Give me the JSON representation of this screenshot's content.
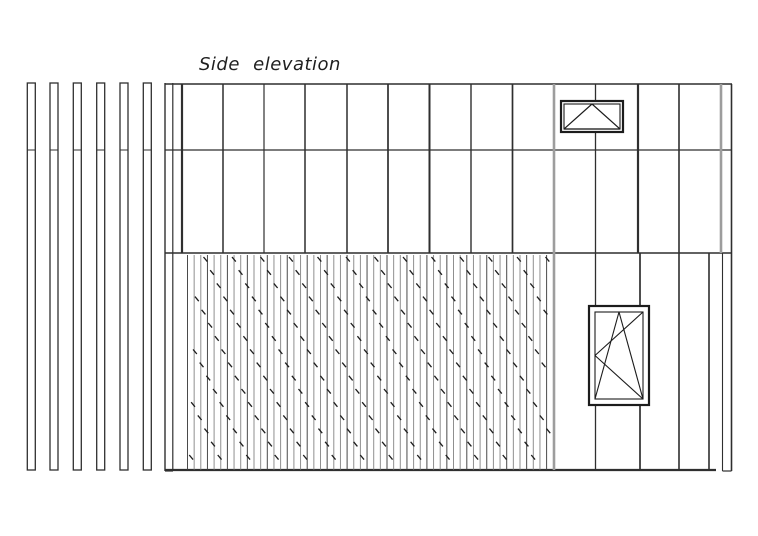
{
  "title": {
    "text": "Side elevation"
  },
  "colors": {
    "background": "#ffffff",
    "line_dark": "#2f2f2f",
    "line_medium": "#4a4a4a",
    "line_light": "#9d9d9d",
    "plank_light": "#8f8f8f",
    "hatch_mark": "#1d1d1d",
    "window_frame": "#1c1c1c"
  },
  "drawing": {
    "canvas": {
      "width": 758,
      "height": 536
    },
    "left_fins": {
      "count": 6,
      "x_positions": [
        27.3,
        50,
        73.3,
        96.7,
        120,
        143.3
      ],
      "width": 8,
      "top": 83,
      "bottom": 470,
      "divider_y": 150
    },
    "facade": {
      "lines": [
        {
          "x1": 165,
          "y1": 84,
          "x2": 732,
          "y2": 84,
          "w": 1.5,
          "tone": "dark"
        },
        {
          "x1": 165,
          "y1": 150,
          "x2": 732,
          "y2": 150,
          "w": 1.2,
          "tone": "dark"
        },
        {
          "x1": 165,
          "y1": 253,
          "x2": 732,
          "y2": 253,
          "w": 1.5,
          "tone": "dark"
        },
        {
          "x1": 165,
          "y1": 470,
          "x2": 716,
          "y2": 470,
          "w": 2.2,
          "tone": "dark"
        },
        {
          "x1": 165,
          "y1": 471,
          "x2": 173,
          "y2": 471,
          "w": 1.2,
          "tone": "dark"
        },
        {
          "x1": 722.5,
          "y1": 471,
          "x2": 731.5,
          "y2": 471,
          "w": 1.2,
          "tone": "dark"
        },
        {
          "x1": 165,
          "y1": 83,
          "x2": 165,
          "y2": 471,
          "w": 1.4,
          "tone": "dark"
        },
        {
          "x1": 172.8,
          "y1": 83,
          "x2": 172.8,
          "y2": 471,
          "w": 1.2,
          "tone": "dark"
        },
        {
          "x1": 182,
          "y1": 84,
          "x2": 182,
          "y2": 253,
          "w": 2.2,
          "tone": "dark"
        },
        {
          "x1": 223,
          "y1": 84,
          "x2": 223,
          "y2": 253,
          "w": 1.5,
          "tone": "dark"
        },
        {
          "x1": 264,
          "y1": 84,
          "x2": 264,
          "y2": 253,
          "w": 1.2,
          "tone": "dark"
        },
        {
          "x1": 305,
          "y1": 84,
          "x2": 305,
          "y2": 253,
          "w": 1.5,
          "tone": "dark"
        },
        {
          "x1": 347,
          "y1": 84,
          "x2": 347,
          "y2": 253,
          "w": 1.5,
          "tone": "dark"
        },
        {
          "x1": 388,
          "y1": 84,
          "x2": 388,
          "y2": 253,
          "w": 1.7,
          "tone": "dark"
        },
        {
          "x1": 429.5,
          "y1": 84,
          "x2": 429.5,
          "y2": 253,
          "w": 2.0,
          "tone": "dark"
        },
        {
          "x1": 471,
          "y1": 84,
          "x2": 471,
          "y2": 253,
          "w": 1.4,
          "tone": "dark"
        },
        {
          "x1": 512.5,
          "y1": 84,
          "x2": 512.5,
          "y2": 253,
          "w": 1.7,
          "tone": "dark"
        },
        {
          "x1": 554,
          "y1": 84,
          "x2": 554,
          "y2": 470,
          "w": 2.6,
          "tone": "light"
        },
        {
          "x1": 595.5,
          "y1": 84,
          "x2": 595.5,
          "y2": 101,
          "w": 1.3,
          "tone": "dark"
        },
        {
          "x1": 595.5,
          "y1": 132,
          "x2": 595.5,
          "y2": 306,
          "w": 1.3,
          "tone": "dark"
        },
        {
          "x1": 595.5,
          "y1": 405,
          "x2": 595.5,
          "y2": 470,
          "w": 1.3,
          "tone": "dark"
        },
        {
          "x1": 638,
          "y1": 84,
          "x2": 638,
          "y2": 253,
          "w": 2.2,
          "tone": "dark"
        },
        {
          "x1": 640,
          "y1": 253,
          "x2": 640,
          "y2": 306,
          "w": 1.7,
          "tone": "dark"
        },
        {
          "x1": 640,
          "y1": 405,
          "x2": 640,
          "y2": 470,
          "w": 1.7,
          "tone": "dark"
        },
        {
          "x1": 679,
          "y1": 84,
          "x2": 679,
          "y2": 470,
          "w": 1.6,
          "tone": "dark"
        },
        {
          "x1": 709,
          "y1": 253,
          "x2": 709,
          "y2": 470,
          "w": 1.6,
          "tone": "dark"
        },
        {
          "x1": 721,
          "y1": 84,
          "x2": 721,
          "y2": 253,
          "w": 2.6,
          "tone": "light"
        },
        {
          "x1": 722.5,
          "y1": 253,
          "x2": 722.5,
          "y2": 471,
          "w": 1.1,
          "tone": "dark"
        },
        {
          "x1": 731.5,
          "y1": 84,
          "x2": 731.5,
          "y2": 471,
          "w": 1.6,
          "tone": "dark"
        }
      ]
    },
    "hatch": {
      "left": 187.5,
      "right": 553,
      "top": 255,
      "bottom": 469.5,
      "plank_spacing": 6.65,
      "chain_base_x": 175,
      "chain_spacing": 28.5,
      "chain_first": -3,
      "chain_last": 13,
      "step_dx": 6.65,
      "step_dy": 13.2,
      "mark_dx": 3.8,
      "mark_dy": 4.6,
      "marks_per_chain": 17
    },
    "awning_window": {
      "type": "top-hung awning window",
      "x": 561,
      "y": 101,
      "w": 62,
      "h": 31,
      "inset": 3
    },
    "tilt_turn_window": {
      "type": "tilt-and-turn window",
      "x": 589,
      "y": 306,
      "w": 60,
      "h": 99,
      "inset": 6
    }
  }
}
